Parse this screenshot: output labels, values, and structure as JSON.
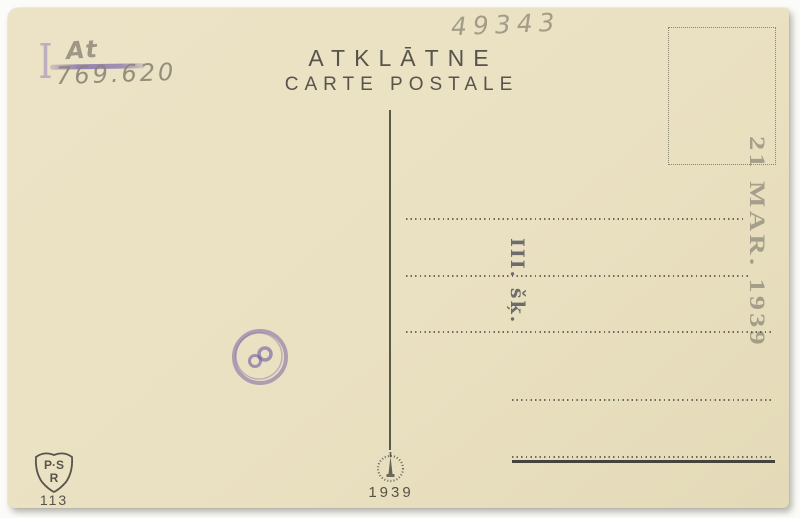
{
  "card": {
    "title": "ATKLĀTNE",
    "subtitle": "CARTE POSTALE",
    "pencil": {
      "top_number": "49343",
      "crossed_word": "At",
      "catalog_number": "769.620",
      "roman_numeral": "I"
    },
    "stamps": {
      "date": "21 MAR. 1939",
      "class": "III. šķ.",
      "round_mark": "circular-purple-handstamp"
    },
    "publisher": {
      "shield_top": "P·S",
      "shield_bottom": "R",
      "card_number": "113"
    },
    "printer": {
      "year": "1939",
      "emblem": "spire-ring-emblem"
    },
    "colors": {
      "paper": "#ebe2c3",
      "ink": "#55524a",
      "pencil": "#8b8576",
      "purple": "#7862aa",
      "stamp_gray": "#8d887b"
    }
  }
}
